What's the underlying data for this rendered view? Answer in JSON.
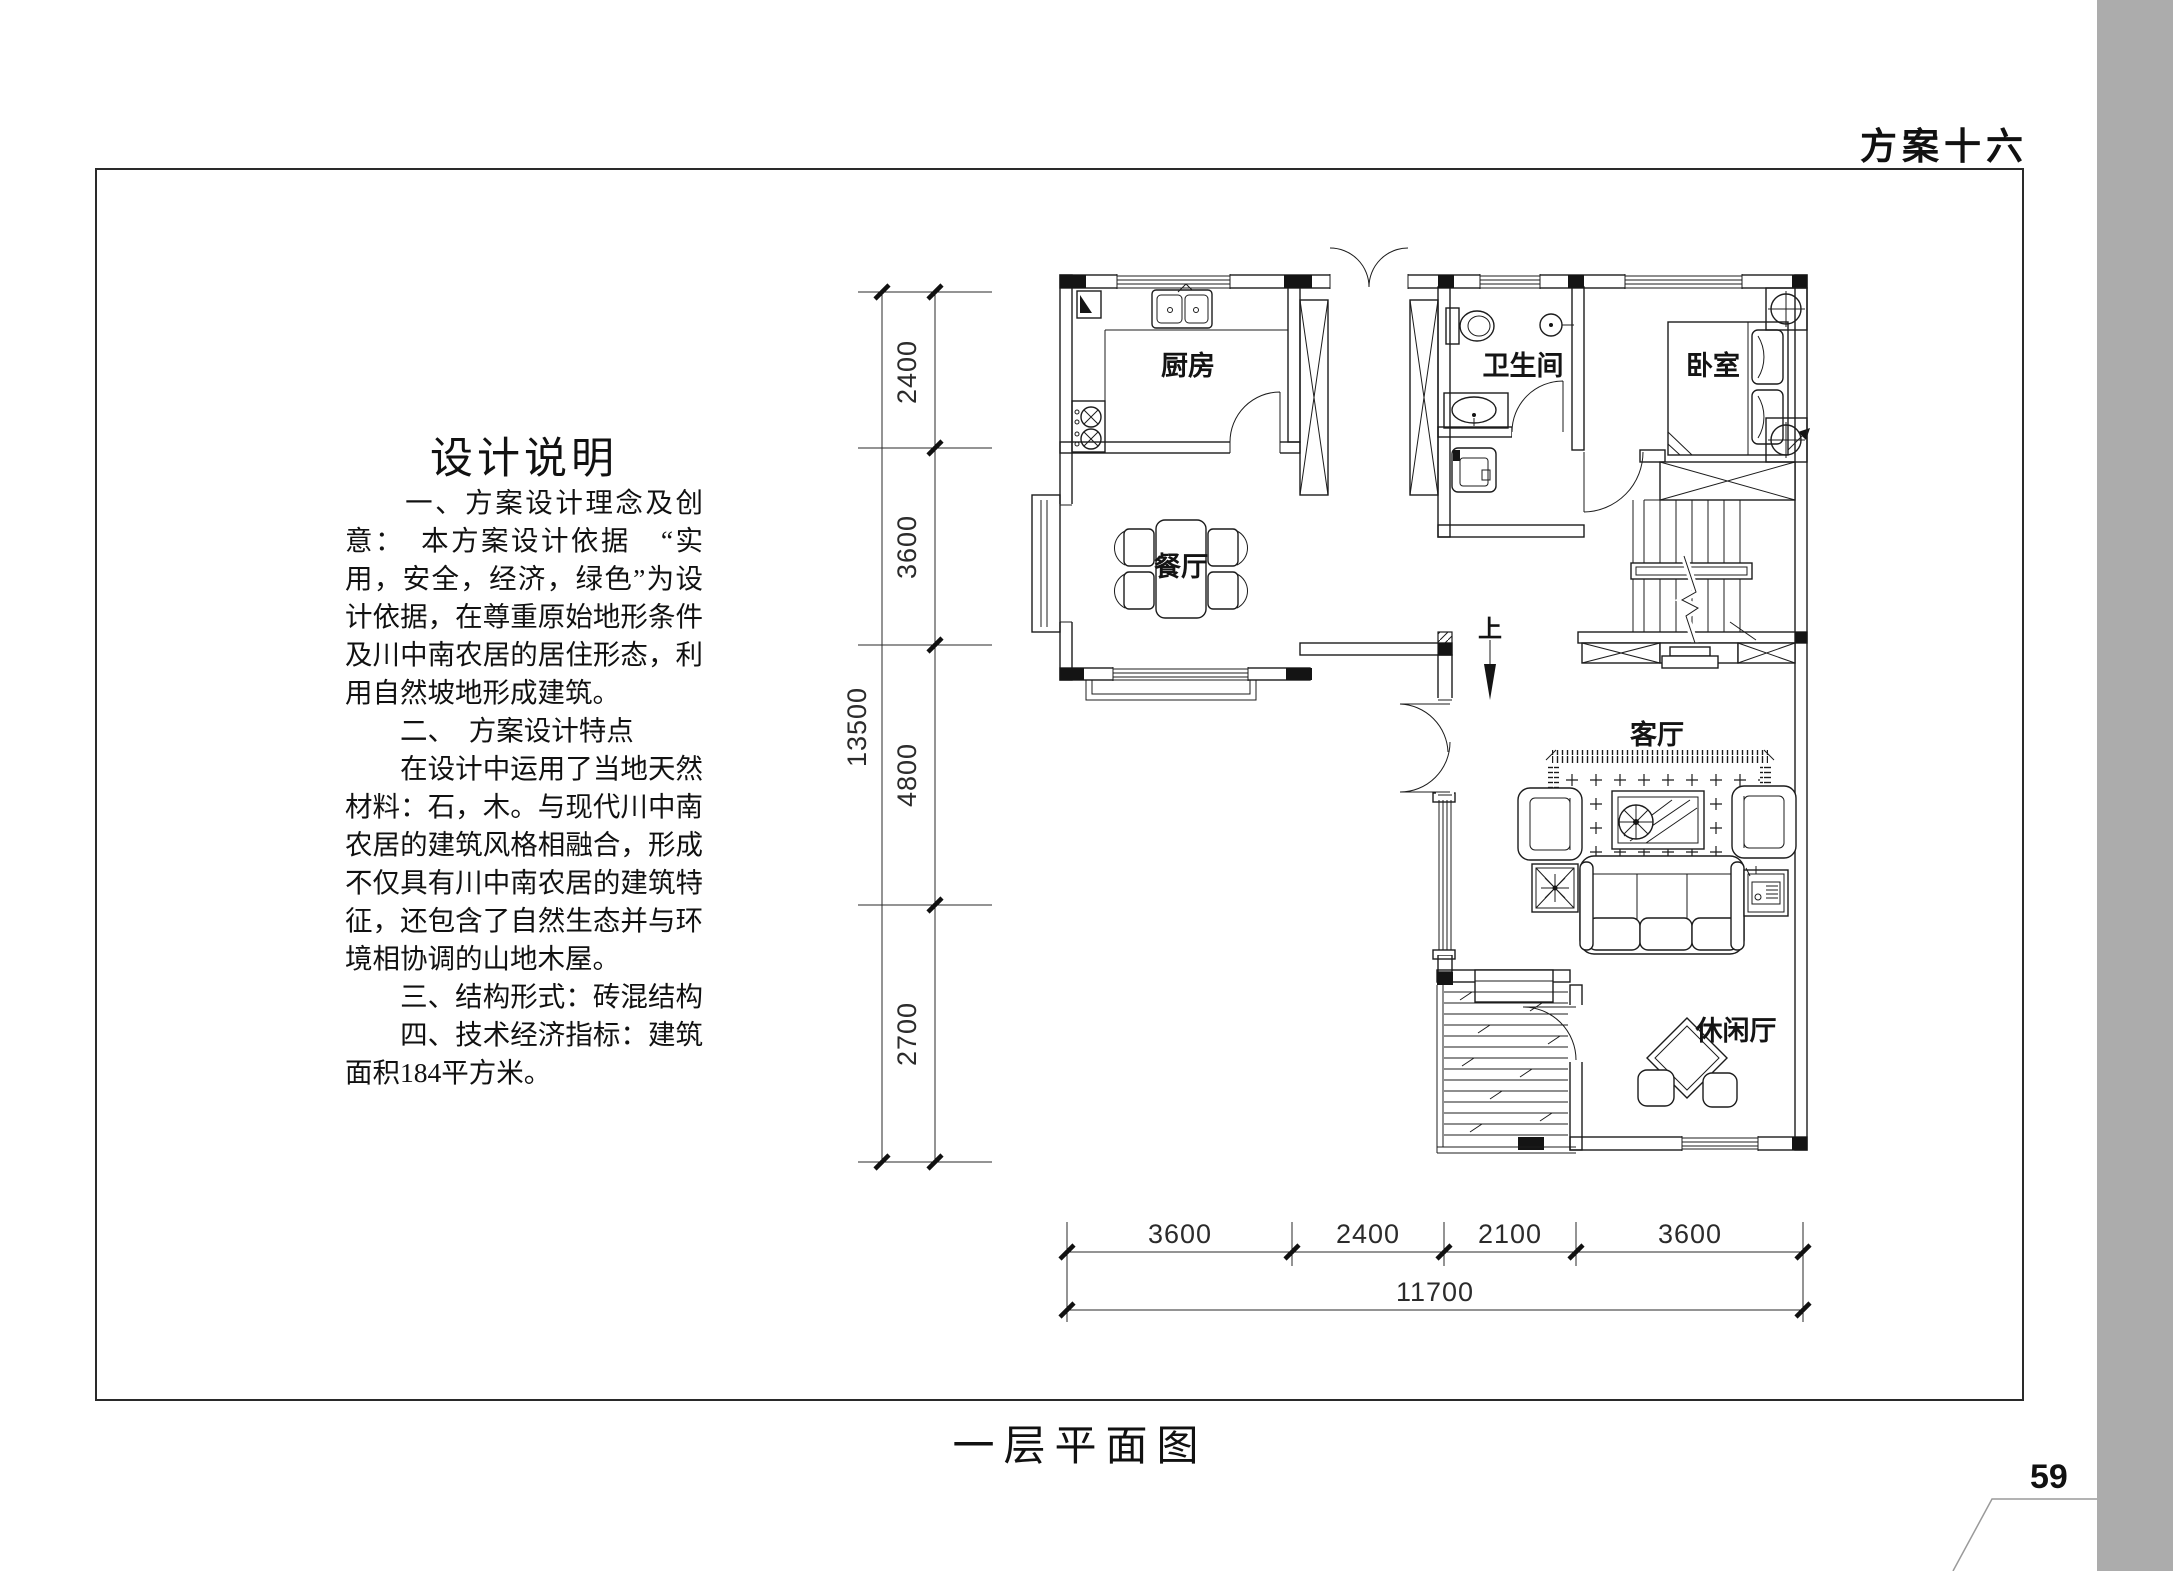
{
  "page": {
    "header_title": "方案十六",
    "page_number": "59",
    "caption": "一层平面图"
  },
  "colors": {
    "sidebar_gray": "#ACACAC",
    "line": "#1c1c1c"
  },
  "design_notes": {
    "title": "设计说明",
    "lines": [
      "　　一、方案设计理念及创",
      "意：　本方案设计依据　“实",
      "用，安全，经济，绿色”为设",
      "计依据，在尊重原始地形条件",
      "及川中南农居的居住形态，利",
      "用自然坡地形成建筑。",
      "　　二、　方案设计特点",
      "　　在设计中运用了当地天然",
      "材料：石，木。与现代川中南",
      "农居的建筑风格相融合，形成",
      "不仅具有川中南农居的建筑特",
      "征，还包含了自然生态并与环",
      "境相协调的山地木屋。",
      "　　三、结构形式：砖混结构",
      "　　四、技术经济指标：建筑",
      "面积184平方米。"
    ]
  },
  "plan": {
    "rooms": {
      "kitchen": "厨房",
      "bathroom": "卫生间",
      "bedroom": "卧室",
      "dining": "餐厅",
      "living": "客厅",
      "leisure": "休闲厅"
    },
    "stair_label": "上",
    "dims": {
      "left": [
        "2400",
        "3600",
        "4800",
        "2700"
      ],
      "left_total": "13500",
      "bottom": [
        "3600",
        "2400",
        "2100",
        "3600"
      ],
      "bottom_total": "11700"
    }
  }
}
